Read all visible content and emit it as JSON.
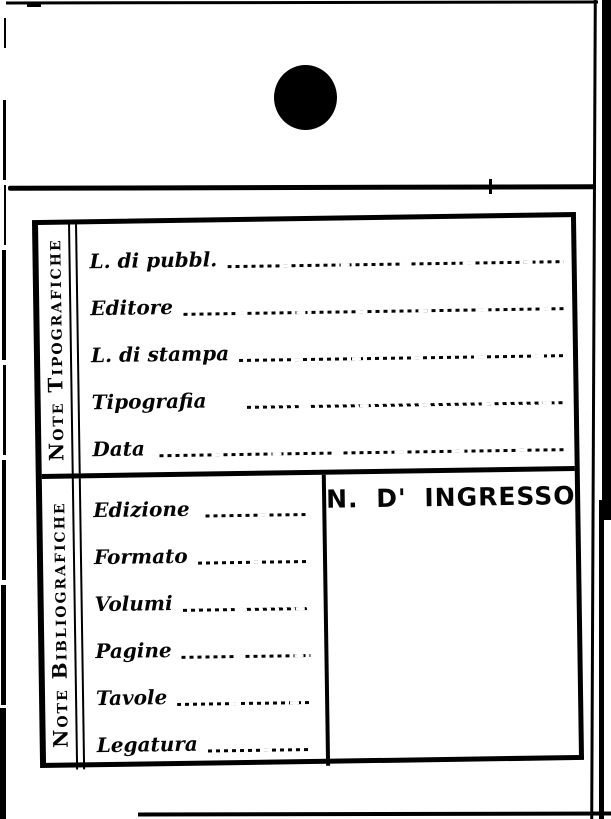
{
  "colors": {
    "ink": "#000000",
    "paper": "#ffffff"
  },
  "punch_hole": {
    "shape": "filled-circle"
  },
  "card": {
    "sections": [
      {
        "side_label": "Note Tipografiche",
        "fields": [
          {
            "label": "L. di pubbl.",
            "value": ""
          },
          {
            "label": "Editore",
            "value": ""
          },
          {
            "label": "L. di stampa",
            "value": ""
          },
          {
            "label": "Tipografia",
            "value": ""
          },
          {
            "label": "Data",
            "value": ""
          }
        ]
      },
      {
        "side_label": "Note Bibliografiche",
        "fields": [
          {
            "label": "Edizione",
            "value": ""
          },
          {
            "label": "Formato",
            "value": ""
          },
          {
            "label": "Volumi",
            "value": ""
          },
          {
            "label": "Pagine",
            "value": ""
          },
          {
            "label": "Tavole",
            "value": ""
          },
          {
            "label": "Legatura",
            "value": ""
          }
        ],
        "ingresso": {
          "label": "N. D' INGRESSO",
          "value": ""
        }
      }
    ]
  }
}
